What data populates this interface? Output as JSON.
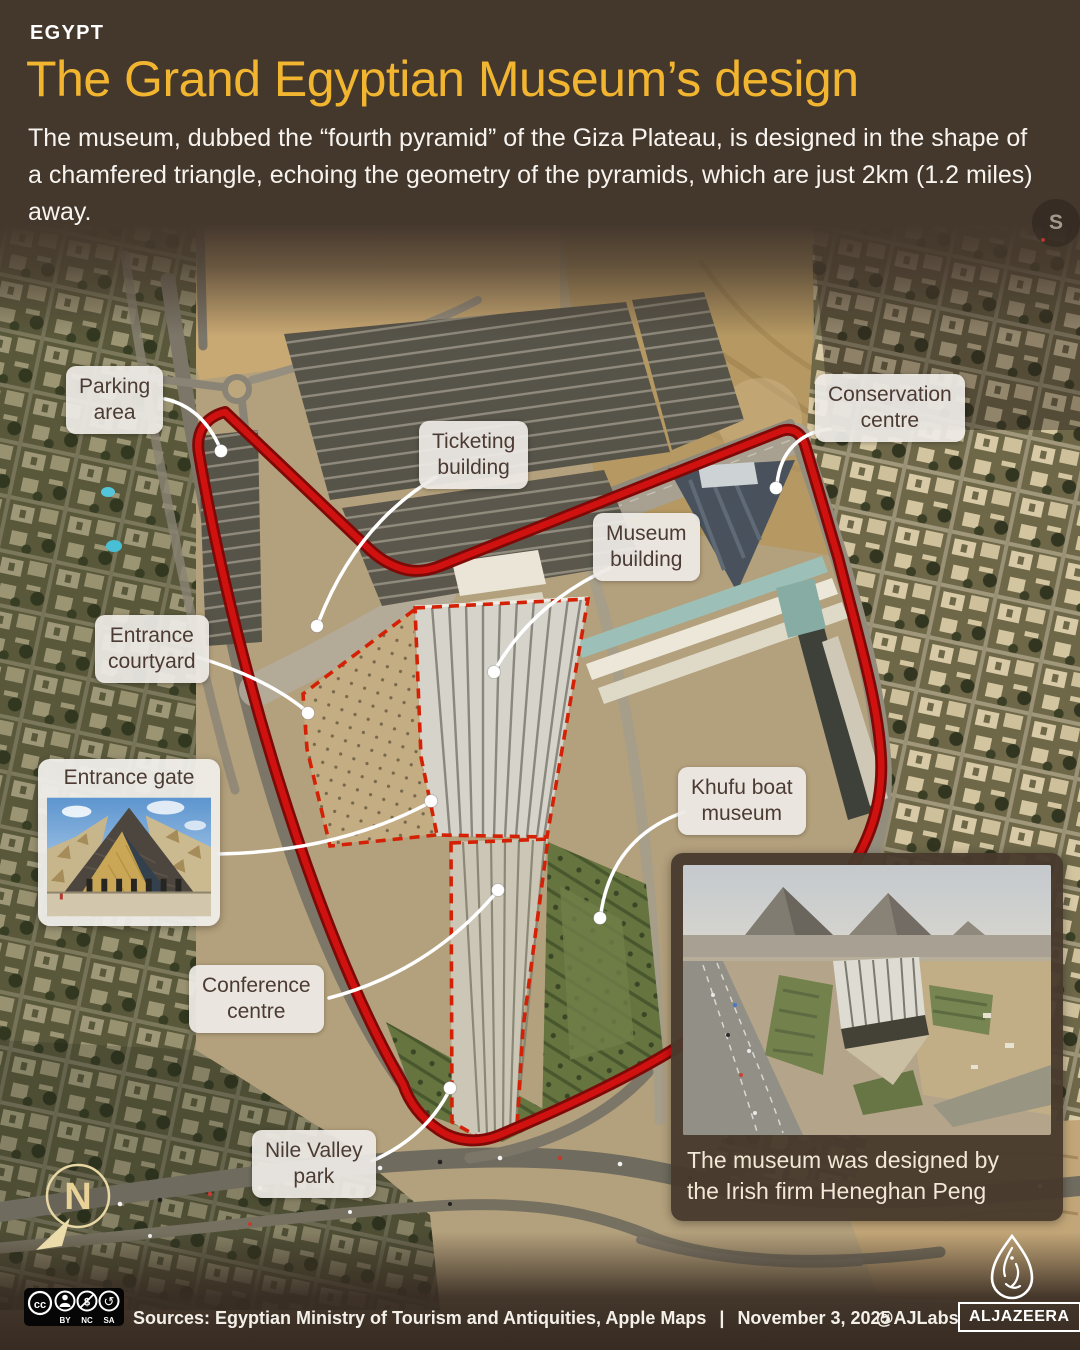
{
  "header": {
    "kicker": "EGYPT",
    "title": "The Grand Egyptian Museum’s design",
    "description": "The museum, dubbed the “fourth pyramid” of the Giza Plateau, is designed in the shape of a chamfered triangle, echoing the geometry of the pyramids, which are just 2km (1.2 miles) away."
  },
  "map": {
    "labels": {
      "parking": {
        "text": "Parking\narea"
      },
      "ticketing": {
        "text": "Ticketing\nbuilding"
      },
      "conservation": {
        "text": "Conservation\ncentre"
      },
      "museum": {
        "text": "Museum\nbuilding"
      },
      "courtyard": {
        "text": "Entrance\ncourtyard"
      },
      "khufu": {
        "text": "Khufu boat\nmuseum"
      },
      "conference": {
        "text": "Conference\ncentre"
      },
      "nile": {
        "text": "Nile Valley\npark"
      }
    },
    "compass": {
      "letter": "N"
    },
    "imagery_badge": {
      "letter": "S"
    }
  },
  "insets": {
    "entrance_gate": {
      "title": "Entrance gate"
    },
    "aerial": {
      "caption": "The museum was designed by\nthe Irish firm Heneghan Peng"
    }
  },
  "footer": {
    "sources": "Sources: Egyptian Ministry of Tourism and Antiquities, Apple Maps",
    "separator": "|",
    "date": "November 3, 2025",
    "credit": "@AJLabs",
    "brand": "ALJAZEERA",
    "license": {
      "cc": "cc",
      "by": "BY",
      "nc": "NC",
      "sa": "SA",
      "nc_glyph": "$",
      "sa_glyph": "↺"
    }
  },
  "colors": {
    "accent_yellow": "#f2b530",
    "boundary_red": "#c30d0b",
    "dashed_red": "#d42105",
    "label_bg": "#eeebe6",
    "label_text": "#4b3b33",
    "background_brown": "#44372c"
  }
}
